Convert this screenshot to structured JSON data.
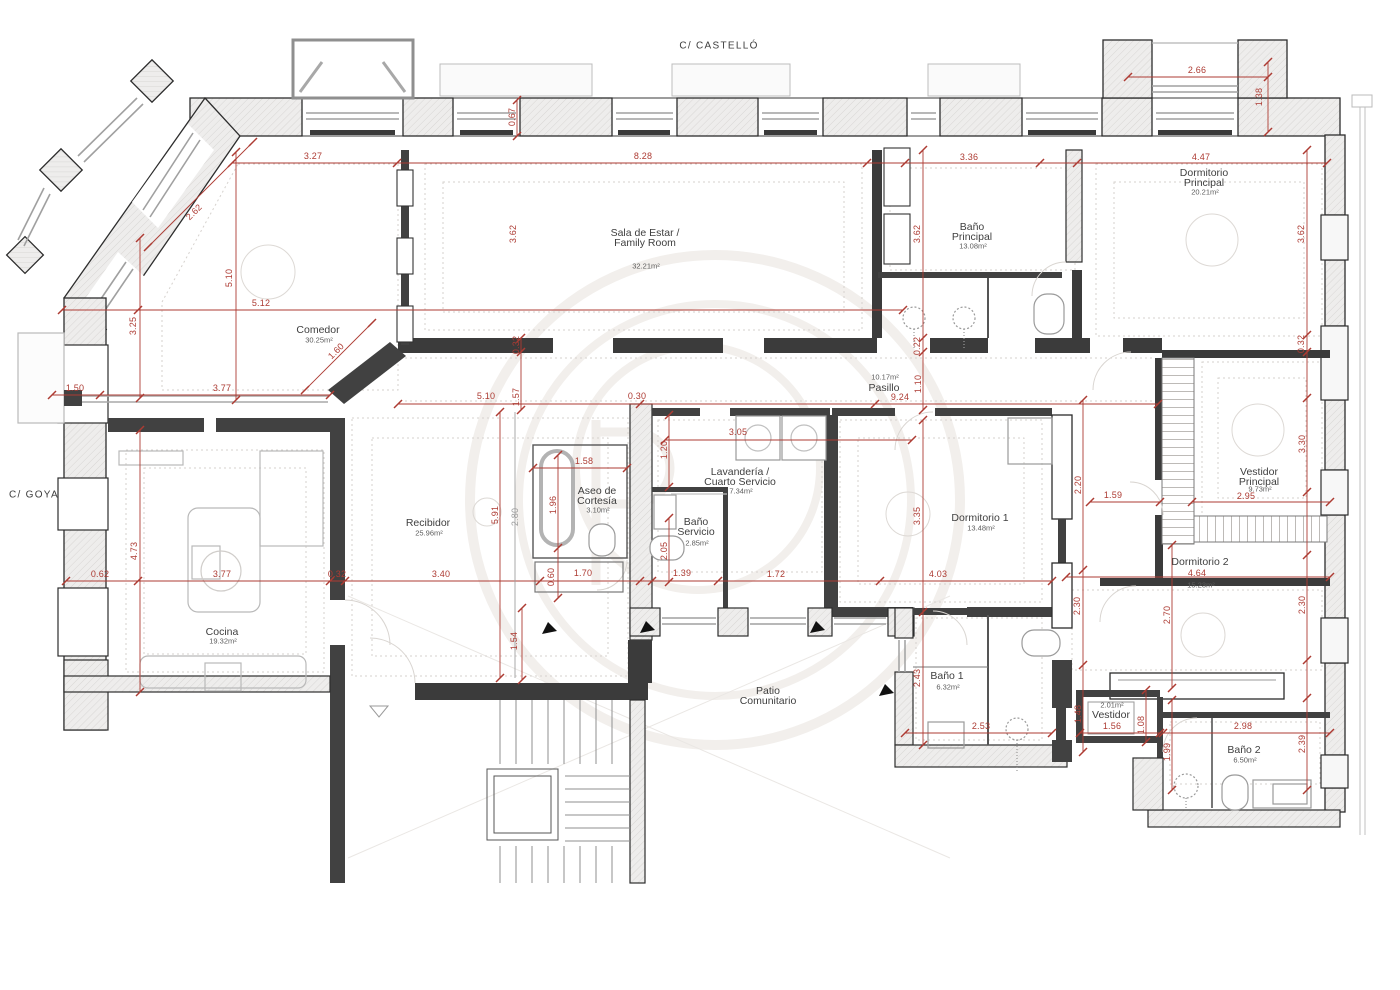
{
  "title": "Floor plan – apartment at C/ Castelló and C/ Goya",
  "colors": {
    "dimension_red": "#ad3b33",
    "dimension_gray": "#9b9b9b",
    "wall_dark": "#2d2d2d",
    "fixture_gray": "#9a9a9a"
  },
  "streets": [
    {
      "id": "castello",
      "label": "C/ CASTELLÓ",
      "x": 719,
      "y": 46
    },
    {
      "id": "goya",
      "label": "C/ GOYA",
      "x": 34,
      "y": 495
    }
  ],
  "rooms": [
    {
      "id": "comedor",
      "lines": [
        "Comedor"
      ],
      "area": "30.25m²",
      "x": 318,
      "y": 330,
      "ay": 340
    },
    {
      "id": "sala-de-estar",
      "lines": [
        "Sala de Estar /",
        "Family Room"
      ],
      "area": "32.21m²",
      "x": 645,
      "y": 233,
      "ay": 266
    },
    {
      "id": "bano-principal",
      "lines": [
        "Baño",
        "Principal"
      ],
      "area": "13.08m²",
      "x": 972,
      "y": 227,
      "ay": 246
    },
    {
      "id": "dormitorio-principal",
      "lines": [
        "Dormitorio",
        "Principal"
      ],
      "area": "20.21m²",
      "x": 1204,
      "y": 173,
      "ay": 192
    },
    {
      "id": "pasillo",
      "lines": [
        "Pasillo"
      ],
      "area": "10.17m²",
      "x": 884,
      "y": 388,
      "ay": 377
    },
    {
      "id": "recibidor",
      "lines": [
        "Recibidor"
      ],
      "area": "25.96m²",
      "x": 428,
      "y": 523,
      "ay": 533
    },
    {
      "id": "cocina",
      "lines": [
        "Cocina"
      ],
      "area": "19.32m²",
      "x": 222,
      "y": 632,
      "ay": 641
    },
    {
      "id": "aseo-de-cortesia",
      "lines": [
        "Aseo de",
        "Cortesía"
      ],
      "area": "3.10m²",
      "x": 597,
      "y": 491,
      "ay": 510
    },
    {
      "id": "lavanderia",
      "lines": [
        "Lavandería /",
        "Cuarto Servicio"
      ],
      "area": "7.34m²",
      "x": 740,
      "y": 472,
      "ay": 491
    },
    {
      "id": "bano-servicio",
      "lines": [
        "Baño",
        "Servicio"
      ],
      "area": "2.85m²",
      "x": 696,
      "y": 522,
      "ay": 543
    },
    {
      "id": "dormitorio-1",
      "lines": [
        "Dormitorio 1"
      ],
      "area": "13.48m²",
      "x": 980,
      "y": 518,
      "ay": 528
    },
    {
      "id": "vestidor-principal",
      "lines": [
        "Vestidor",
        "Principal"
      ],
      "area": "9.73m²",
      "x": 1259,
      "y": 472,
      "ay": 489
    },
    {
      "id": "dormitorio-2",
      "lines": [
        "Dormitorio 2"
      ],
      "area": "15.23m²",
      "x": 1200,
      "y": 562,
      "ay": 585
    },
    {
      "id": "bano-1",
      "lines": [
        "Baño 1"
      ],
      "area": "6.32m²",
      "x": 947,
      "y": 676,
      "ay": 687
    },
    {
      "id": "vestidor",
      "lines": [
        "Vestidor"
      ],
      "area": "2.01m²",
      "x": 1111,
      "y": 715,
      "ay": 705
    },
    {
      "id": "bano-2",
      "lines": [
        "Baño 2"
      ],
      "area": "6.50m²",
      "x": 1244,
      "y": 750,
      "ay": 760
    },
    {
      "id": "patio-comunitario",
      "lines": [
        "Patio",
        "Comunitario"
      ],
      "area": "",
      "x": 768,
      "y": 691,
      "ay": 0
    }
  ],
  "dimensions": [
    {
      "v": "0.67",
      "x": 512,
      "y": 117,
      "r": -90
    },
    {
      "v": "8.28",
      "x": 643,
      "y": 156
    },
    {
      "v": "3.27",
      "x": 313,
      "y": 156
    },
    {
      "v": "2.62",
      "x": 194,
      "y": 212,
      "r": -45
    },
    {
      "v": "3.36",
      "x": 969,
      "y": 157
    },
    {
      "v": "4.47",
      "x": 1201,
      "y": 157
    },
    {
      "v": "2.66",
      "x": 1197,
      "y": 70
    },
    {
      "v": "1.38",
      "x": 1259,
      "y": 97,
      "r": -90
    },
    {
      "v": "3.62",
      "x": 513,
      "y": 234,
      "r": -90
    },
    {
      "v": "3.62",
      "x": 917,
      "y": 234,
      "r": -90
    },
    {
      "v": "3.62",
      "x": 1301,
      "y": 234,
      "r": -90
    },
    {
      "v": "5.10",
      "x": 229,
      "y": 278,
      "r": -90
    },
    {
      "v": "5.12",
      "x": 261,
      "y": 303
    },
    {
      "v": "3.25",
      "x": 133,
      "y": 326,
      "r": -90
    },
    {
      "v": "1.60",
      "x": 336,
      "y": 351,
      "r": -45
    },
    {
      "v": "1.50",
      "x": 75,
      "y": 388
    },
    {
      "v": "3.77",
      "x": 222,
      "y": 388
    },
    {
      "v": "0.32",
      "x": 516,
      "y": 345,
      "r": -90
    },
    {
      "v": "0.22",
      "x": 917,
      "y": 346,
      "r": -90
    },
    {
      "v": "0.32",
      "x": 1301,
      "y": 344,
      "r": -90
    },
    {
      "v": "5.10",
      "x": 486,
      "y": 396
    },
    {
      "v": "1.57",
      "x": 516,
      "y": 397,
      "r": -90
    },
    {
      "v": "0.30",
      "x": 637,
      "y": 396
    },
    {
      "v": "9.24",
      "x": 900,
      "y": 397
    },
    {
      "v": "1.10",
      "x": 918,
      "y": 384,
      "r": -90
    },
    {
      "v": "3.05",
      "x": 738,
      "y": 432
    },
    {
      "v": "1.20",
      "x": 664,
      "y": 450,
      "r": -90
    },
    {
      "v": "1.58",
      "x": 584,
      "y": 461
    },
    {
      "v": "1.96",
      "x": 553,
      "y": 505,
      "r": -90
    },
    {
      "v": "5.91",
      "x": 495,
      "y": 515,
      "r": -90
    },
    {
      "v": "2.80",
      "x": 515,
      "y": 517,
      "r": -90,
      "c": "gray"
    },
    {
      "v": "2.05",
      "x": 664,
      "y": 551,
      "r": -90
    },
    {
      "v": "1.39",
      "x": 682,
      "y": 573
    },
    {
      "v": "1.72",
      "x": 776,
      "y": 574
    },
    {
      "v": "4.03",
      "x": 938,
      "y": 574
    },
    {
      "v": "3.35",
      "x": 917,
      "y": 516,
      "r": -90
    },
    {
      "v": "2.20",
      "x": 1078,
      "y": 485,
      "r": -90
    },
    {
      "v": "1.59",
      "x": 1113,
      "y": 495
    },
    {
      "v": "2.95",
      "x": 1246,
      "y": 496
    },
    {
      "v": "3.30",
      "x": 1302,
      "y": 444,
      "r": -90
    },
    {
      "v": "0.62",
      "x": 100,
      "y": 574
    },
    {
      "v": "4.73",
      "x": 134,
      "y": 551,
      "r": -90
    },
    {
      "v": "3.77",
      "x": 222,
      "y": 574
    },
    {
      "v": "0.32",
      "x": 337,
      "y": 574
    },
    {
      "v": "3.40",
      "x": 441,
      "y": 574
    },
    {
      "v": "0.60",
      "x": 551,
      "y": 577,
      "r": -90
    },
    {
      "v": "1.70",
      "x": 583,
      "y": 573
    },
    {
      "v": "1.54",
      "x": 514,
      "y": 641,
      "r": -90
    },
    {
      "v": "2.43",
      "x": 917,
      "y": 678,
      "r": -90
    },
    {
      "v": "2.53",
      "x": 981,
      "y": 726
    },
    {
      "v": "2.30",
      "x": 1077,
      "y": 606,
      "r": -90
    },
    {
      "v": "2.70",
      "x": 1167,
      "y": 615,
      "r": -90
    },
    {
      "v": "2.30",
      "x": 1302,
      "y": 605,
      "r": -90
    },
    {
      "v": "4.64",
      "x": 1197,
      "y": 573
    },
    {
      "v": "1.48",
      "x": 1078,
      "y": 714,
      "r": -90
    },
    {
      "v": "1.56",
      "x": 1112,
      "y": 726
    },
    {
      "v": "1.08",
      "x": 1141,
      "y": 725,
      "r": -90
    },
    {
      "v": "1.99",
      "x": 1167,
      "y": 752,
      "r": -90
    },
    {
      "v": "2.98",
      "x": 1243,
      "y": 726
    },
    {
      "v": "2.39",
      "x": 1302,
      "y": 744,
      "r": -90
    }
  ]
}
